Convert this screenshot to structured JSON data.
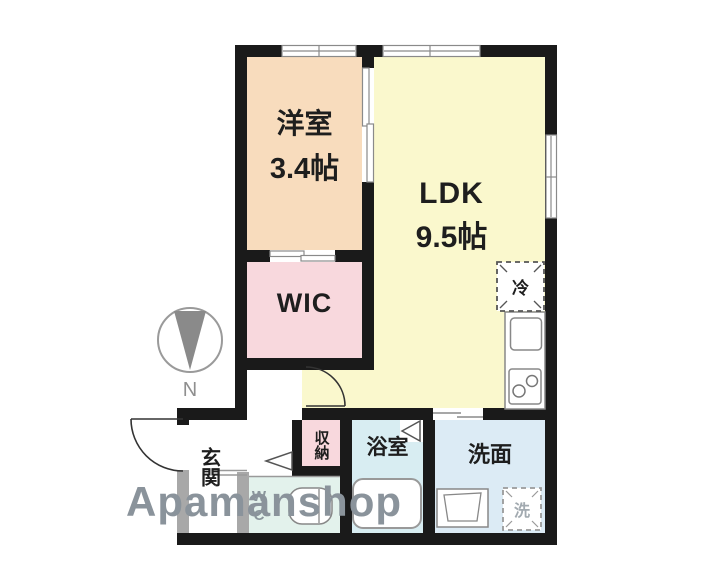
{
  "floorplan": {
    "watermark": "Apamanshop",
    "compass": {
      "label": "N"
    },
    "rooms": {
      "western_room": {
        "name": "洋室",
        "area": "3.4帖"
      },
      "ldk": {
        "name": "LDK",
        "area": "9.5帖"
      },
      "wic": {
        "name": "WIC"
      },
      "entrance": {
        "name": "玄関"
      },
      "storage": {
        "name": "収納"
      },
      "bathroom": {
        "name": "浴室"
      },
      "washroom": {
        "name": "洗面"
      },
      "wc": {
        "display": "W\nC"
      }
    },
    "fixtures": {
      "refrigerator": "冷",
      "washing_machine": "洗"
    },
    "colors": {
      "wall": "#1a1a1a",
      "wall_light": "#a8a8a8",
      "western_room_fill": "#f8dcbd",
      "wic_fill": "#f8d8dd",
      "ldk_fill": "#faf8cd",
      "bath_fill": "#d8edf2",
      "washroom_fill": "#dcebf5",
      "wc_fill": "#e3f2ec",
      "watermark_gray": "#8a939b",
      "compass_gray": "#8c8c8c"
    }
  }
}
